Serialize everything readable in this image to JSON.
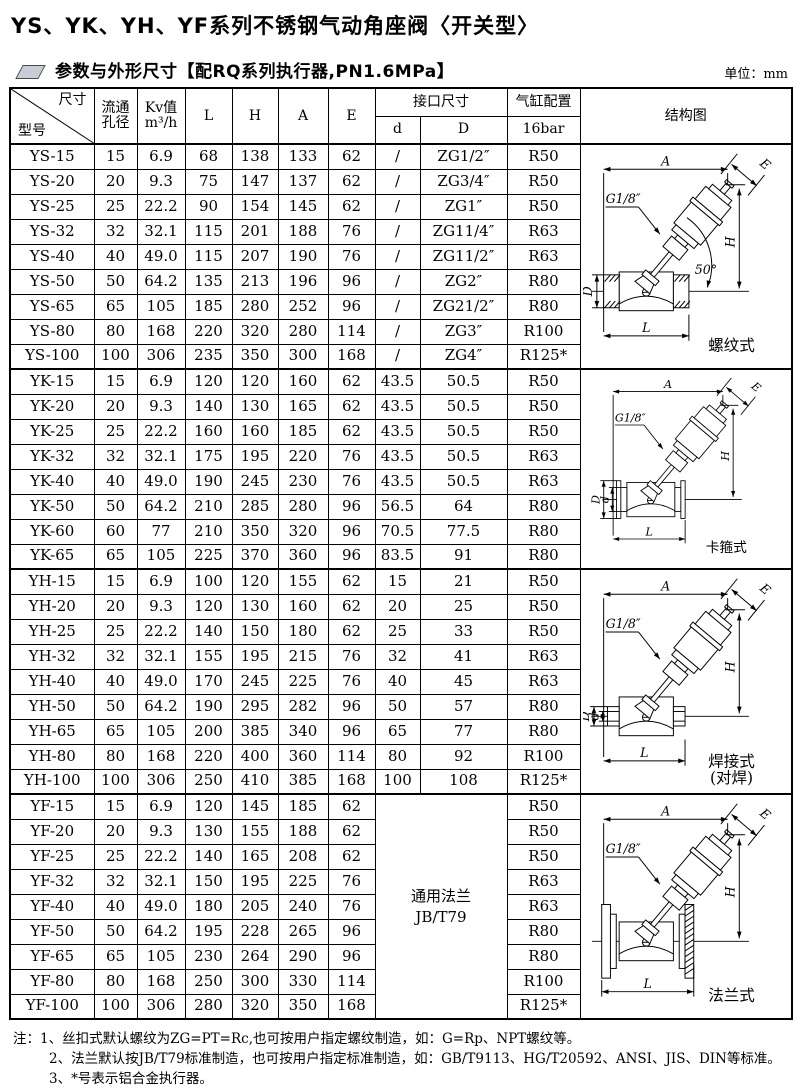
{
  "page": {
    "title": "YS、YK、YH、YF系列不锈钢气动角座阀〈开关型〉",
    "section_title": "参数与外形尺寸【配RQ系列执行器,PN1.6MPa】",
    "unit_label": "单位：mm"
  },
  "colors": {
    "line": "#000000",
    "background": "#ffffff",
    "section_icon_fill": "#c9cdd6"
  },
  "table": {
    "header": {
      "size": "尺寸",
      "model": "型号",
      "flow1": "流通",
      "flow2": "孔径",
      "kv1": "Kv值",
      "kv2": "m³/h",
      "L": "L",
      "H": "H",
      "A": "A",
      "E": "E",
      "port": "接口尺寸",
      "d": "d",
      "D": "D",
      "cylinder": "气缸配置",
      "cylinder_sub": "16bar",
      "diagram": "结构图"
    },
    "groups": [
      {
        "series": "YS",
        "diagram": {
          "type": "thread",
          "caption": [
            "螺纹式"
          ],
          "labels": {
            "A": "A",
            "E": "E",
            "H": "H",
            "L": "L",
            "D": "D",
            "port": "G1/8″",
            "angle": "50°"
          }
        },
        "rows": [
          [
            "YS-15",
            "15",
            "6.9",
            "68",
            "138",
            "133",
            "62",
            "/",
            "ZG1/2″",
            "R50"
          ],
          [
            "YS-20",
            "20",
            "9.3",
            "75",
            "147",
            "137",
            "62",
            "/",
            "ZG3/4″",
            "R50"
          ],
          [
            "YS-25",
            "25",
            "22.2",
            "90",
            "154",
            "145",
            "62",
            "/",
            "ZG1″",
            "R50"
          ],
          [
            "YS-32",
            "32",
            "32.1",
            "115",
            "201",
            "188",
            "76",
            "/",
            "ZG11/4″",
            "R63"
          ],
          [
            "YS-40",
            "40",
            "49.0",
            "115",
            "207",
            "190",
            "76",
            "/",
            "ZG11/2″",
            "R63"
          ],
          [
            "YS-50",
            "50",
            "64.2",
            "135",
            "213",
            "196",
            "96",
            "/",
            "ZG2″",
            "R80"
          ],
          [
            "YS-65",
            "65",
            "105",
            "185",
            "280",
            "252",
            "96",
            "/",
            "ZG21/2″",
            "R80"
          ],
          [
            "YS-80",
            "80",
            "168",
            "220",
            "320",
            "280",
            "114",
            "/",
            "ZG3″",
            "R100"
          ],
          [
            "YS-100",
            "100",
            "306",
            "235",
            "350",
            "300",
            "168",
            "/",
            "ZG4″",
            "R125*"
          ]
        ]
      },
      {
        "series": "YK",
        "diagram": {
          "type": "clamp",
          "caption": [
            "卡箍式"
          ],
          "labels": {
            "A": "A",
            "E": "E",
            "H": "H",
            "L": "L",
            "D": "D",
            "d": "d",
            "port": "G1/8″"
          }
        },
        "rows": [
          [
            "YK-15",
            "15",
            "6.9",
            "120",
            "120",
            "160",
            "62",
            "43.5",
            "50.5",
            "R50"
          ],
          [
            "YK-20",
            "20",
            "9.3",
            "140",
            "130",
            "165",
            "62",
            "43.5",
            "50.5",
            "R50"
          ],
          [
            "YK-25",
            "25",
            "22.2",
            "160",
            "160",
            "185",
            "62",
            "43.5",
            "50.5",
            "R50"
          ],
          [
            "YK-32",
            "32",
            "32.1",
            "175",
            "195",
            "220",
            "76",
            "43.5",
            "50.5",
            "R63"
          ],
          [
            "YK-40",
            "40",
            "49.0",
            "190",
            "245",
            "230",
            "76",
            "43.5",
            "50.5",
            "R63"
          ],
          [
            "YK-50",
            "50",
            "64.2",
            "210",
            "285",
            "280",
            "96",
            "56.5",
            "64",
            "R80"
          ],
          [
            "YK-60",
            "60",
            "77",
            "210",
            "350",
            "320",
            "96",
            "70.5",
            "77.5",
            "R80"
          ],
          [
            "YK-65",
            "65",
            "105",
            "225",
            "370",
            "360",
            "96",
            "83.5",
            "91",
            "R80"
          ]
        ]
      },
      {
        "series": "YH",
        "diagram": {
          "type": "weld",
          "caption": [
            "焊接式",
            "(对焊)"
          ],
          "labels": {
            "A": "A",
            "E": "E",
            "H": "H",
            "L": "L",
            "D": "D",
            "d": "d",
            "port": "G1/8″"
          }
        },
        "rows": [
          [
            "YH-15",
            "15",
            "6.9",
            "100",
            "120",
            "155",
            "62",
            "15",
            "21",
            "R50"
          ],
          [
            "YH-20",
            "20",
            "9.3",
            "120",
            "130",
            "160",
            "62",
            "20",
            "25",
            "R50"
          ],
          [
            "YH-25",
            "25",
            "22.2",
            "140",
            "150",
            "180",
            "62",
            "25",
            "33",
            "R50"
          ],
          [
            "YH-32",
            "32",
            "32.1",
            "155",
            "195",
            "215",
            "76",
            "32",
            "41",
            "R63"
          ],
          [
            "YH-40",
            "40",
            "49.0",
            "170",
            "245",
            "225",
            "76",
            "40",
            "45",
            "R63"
          ],
          [
            "YH-50",
            "50",
            "64.2",
            "190",
            "295",
            "282",
            "96",
            "50",
            "57",
            "R80"
          ],
          [
            "YH-65",
            "65",
            "105",
            "200",
            "385",
            "340",
            "96",
            "65",
            "77",
            "R80"
          ],
          [
            "YH-80",
            "80",
            "168",
            "220",
            "400",
            "360",
            "114",
            "80",
            "92",
            "R100"
          ],
          [
            "YH-100",
            "100",
            "306",
            "250",
            "410",
            "385",
            "168",
            "100",
            "108",
            "R125*"
          ]
        ]
      },
      {
        "series": "YF",
        "merged_port": [
          "通用法兰",
          "JB/T79"
        ],
        "diagram": {
          "type": "flange",
          "caption": [
            "法兰式"
          ],
          "labels": {
            "A": "A",
            "E": "E",
            "H": "H",
            "L": "L",
            "port": "G1/8″"
          }
        },
        "rows": [
          [
            "YF-15",
            "15",
            "6.9",
            "120",
            "145",
            "185",
            "62",
            "R50"
          ],
          [
            "YF-20",
            "20",
            "9.3",
            "130",
            "155",
            "188",
            "62",
            "R50"
          ],
          [
            "YF-25",
            "25",
            "22.2",
            "140",
            "165",
            "208",
            "62",
            "R50"
          ],
          [
            "YF-32",
            "32",
            "32.1",
            "150",
            "195",
            "225",
            "76",
            "R63"
          ],
          [
            "YF-40",
            "40",
            "49.0",
            "180",
            "205",
            "240",
            "76",
            "R63"
          ],
          [
            "YF-50",
            "50",
            "64.2",
            "195",
            "228",
            "265",
            "96",
            "R80"
          ],
          [
            "YF-65",
            "65",
            "105",
            "230",
            "264",
            "290",
            "96",
            "R80"
          ],
          [
            "YF-80",
            "80",
            "168",
            "250",
            "300",
            "330",
            "114",
            "R100"
          ],
          [
            "YF-100",
            "100",
            "306",
            "280",
            "320",
            "350",
            "168",
            "R125*"
          ]
        ]
      }
    ]
  },
  "notes": {
    "prefix": "注：",
    "items": [
      "1、丝扣式默认螺纹为ZG=PT=Rc,也可按用户指定螺纹制造，如：G=Rp、NPT螺纹等。",
      "2、法兰默认按JB/T79标准制造，也可按用户指定标准制造，如：GB/T9113、HG/T20592、ANSI、JIS、DIN等标准。",
      "3、*号表示铝合金执行器。"
    ]
  }
}
